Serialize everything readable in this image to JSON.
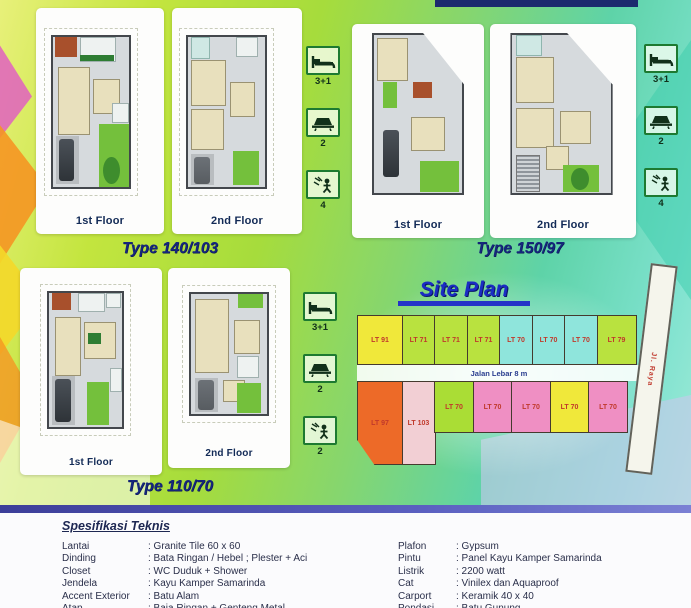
{
  "types": [
    {
      "name": "Type 140/103",
      "floors": [
        "1st Floor",
        "2nd Floor"
      ],
      "stats": [
        {
          "icon": "bed-icon",
          "label": "3+1"
        },
        {
          "icon": "bathroom-icon",
          "label": "2"
        },
        {
          "icon": "shower-icon",
          "label": "4"
        }
      ]
    },
    {
      "name": "Type 150/97",
      "floors": [
        "1st Floor",
        "2nd Floor"
      ],
      "stats": [
        {
          "icon": "bed-icon",
          "label": "3+1"
        },
        {
          "icon": "bathroom-icon",
          "label": "2"
        },
        {
          "icon": "shower-icon",
          "label": "4"
        }
      ]
    },
    {
      "name": "Type 110/70",
      "floors": [
        "1st Floor",
        "2nd Floor"
      ],
      "stats": [
        {
          "icon": "bed-icon",
          "label": "3+1"
        },
        {
          "icon": "bathroom-icon",
          "label": "2"
        },
        {
          "icon": "shower-icon",
          "label": "2"
        }
      ]
    }
  ],
  "site_plan": {
    "title": "Site Plan",
    "street_label": "Jalan Lebar 8 m",
    "road_label": "Jl. Raya",
    "lots_top": [
      {
        "label": "LT 91",
        "color": "#f0e83a"
      },
      {
        "label": "LT 71",
        "color": "#b9e23f"
      },
      {
        "label": "LT 71",
        "color": "#b9e23f"
      },
      {
        "label": "LT 71",
        "color": "#b9e23f"
      },
      {
        "label": "LT 70",
        "color": "#8fe5dc"
      },
      {
        "label": "LT 70",
        "color": "#8fe5dc"
      },
      {
        "label": "LT 70",
        "color": "#8fe5dc"
      },
      {
        "label": "LT 79",
        "color": "#b9e23f"
      }
    ],
    "lots_bottom": [
      {
        "label": "LT 97",
        "color": "#ed6a28"
      },
      {
        "label": "LT 103",
        "color": "#f2cfd4"
      },
      {
        "label": "LT 70",
        "color": "#aadd35"
      },
      {
        "label": "LT 70",
        "color": "#ef8fc3"
      },
      {
        "label": "LT 70",
        "color": "#ef8fc3"
      },
      {
        "label": "LT 70",
        "color": "#f0e83a"
      },
      {
        "label": "LT 70",
        "color": "#ef8fc3"
      }
    ],
    "end_strip_color": "#f0a93c"
  },
  "specs": {
    "heading": "Spesifikasi Teknis",
    "left": [
      {
        "label": "Lantai",
        "value": ": Granite Tile 60 x 60"
      },
      {
        "label": "Dinding",
        "value": ": Bata Ringan / Hebel ; Plester + Aci"
      },
      {
        "label": "Closet",
        "value": ": WC Duduk + Shower"
      },
      {
        "label": "Jendela",
        "value": ": Kayu Kamper Samarinda"
      },
      {
        "label": "Accent Exterior",
        "value": ": Batu Alam"
      },
      {
        "label": "Atap",
        "value": ": Baja Ringan + Genteng Metal"
      }
    ],
    "right": [
      {
        "label": "Plafon",
        "value": ": Gypsum"
      },
      {
        "label": "Pintu",
        "value": ": Panel Kayu Kamper Samarinda"
      },
      {
        "label": "Listrik",
        "value": ": 2200 watt"
      },
      {
        "label": "Cat",
        "value": ": Vinilex dan Aquaproof"
      },
      {
        "label": "Carport",
        "value": ": Keramik 40 x 40"
      },
      {
        "label": "Pondasi",
        "value": ": Batu Gunung"
      }
    ]
  },
  "colors": {
    "accent_navy": "#15267c",
    "site_title_blue": "#1b2cc4",
    "divider_purple": "#3c3e99"
  }
}
